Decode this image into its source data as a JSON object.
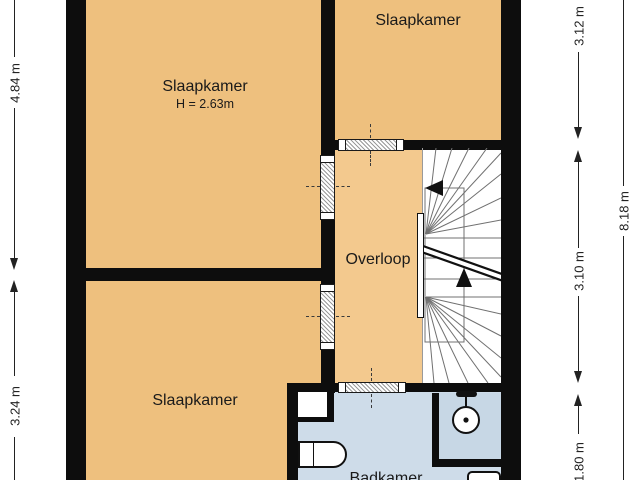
{
  "plan": {
    "title": "Floor plan - first floor (verdieping)",
    "rooms": [
      {
        "name": "slaapkamer-top-left",
        "label": "Slaapkamer",
        "note": "H = 2.63m"
      },
      {
        "name": "slaapkamer-top-right",
        "label": "Slaapkamer"
      },
      {
        "name": "slaapkamer-bottom-left",
        "label": "Slaapkamer"
      },
      {
        "name": "overloop",
        "label": "Overloop"
      },
      {
        "name": "badkamer",
        "label": "Badkamer"
      }
    ],
    "dimensions": {
      "left": [
        {
          "label": "4.84 m"
        },
        {
          "label": "3.24 m"
        }
      ],
      "right": [
        {
          "label": "3.12 m"
        },
        {
          "label": "3.10 m"
        },
        {
          "label": "1.80 m"
        }
      ],
      "outer": [
        {
          "label": "8.18 m"
        }
      ]
    },
    "fixtures": [
      "staircase",
      "toilet",
      "shower-head",
      "washbasin"
    ],
    "colors": {
      "bedroom_fill": "#eec07e",
      "landing_fill": "#f3c98e",
      "bathroom_fill": "#cedce9",
      "shower_fill": "#c7d7e5",
      "wall": "#0d0d0d",
      "stair_line": "#707070",
      "dimension": "#222222"
    }
  }
}
